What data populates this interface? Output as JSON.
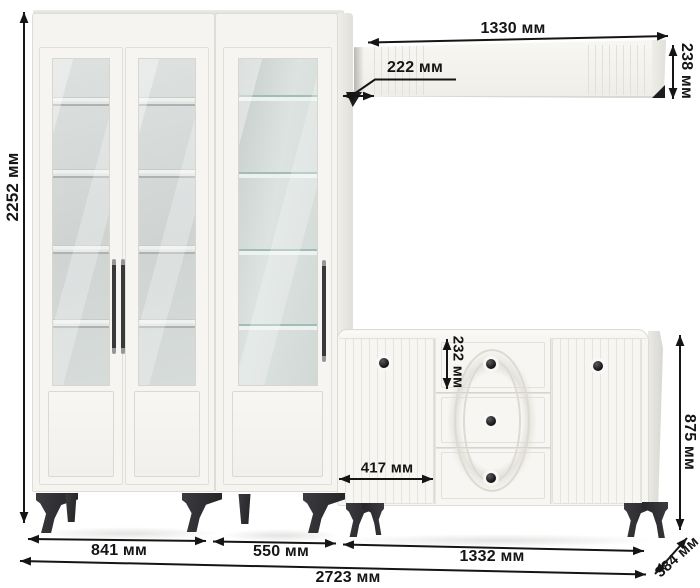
{
  "diagram": {
    "units": "мм",
    "description": "white furniture wall unit with dimension annotations"
  },
  "labels": {
    "total_height": "2252 мм",
    "wall_shelf_width": "1330 мм",
    "wall_shelf_depth": "222 мм",
    "wall_shelf_height": "238 мм",
    "drawer_height": "232 мм",
    "sideboard_door_width": "417 мм",
    "sideboard_height": "875 мм",
    "bookcase_width": "841 мм",
    "display_cabinet_width": "550 мм",
    "sideboard_width": "1332 мм",
    "total_width": "2723 мм",
    "sideboard_depth": "384 мм"
  },
  "colors": {
    "background": "#ffffff",
    "furniture_body": "#f5f4f0",
    "glass": "#d6dad9",
    "glass_shelf_edge": "#9cb8b2",
    "legs": "#2a2a2d",
    "knobs": "#1c1c1e",
    "dimension_lines": "#151515"
  }
}
